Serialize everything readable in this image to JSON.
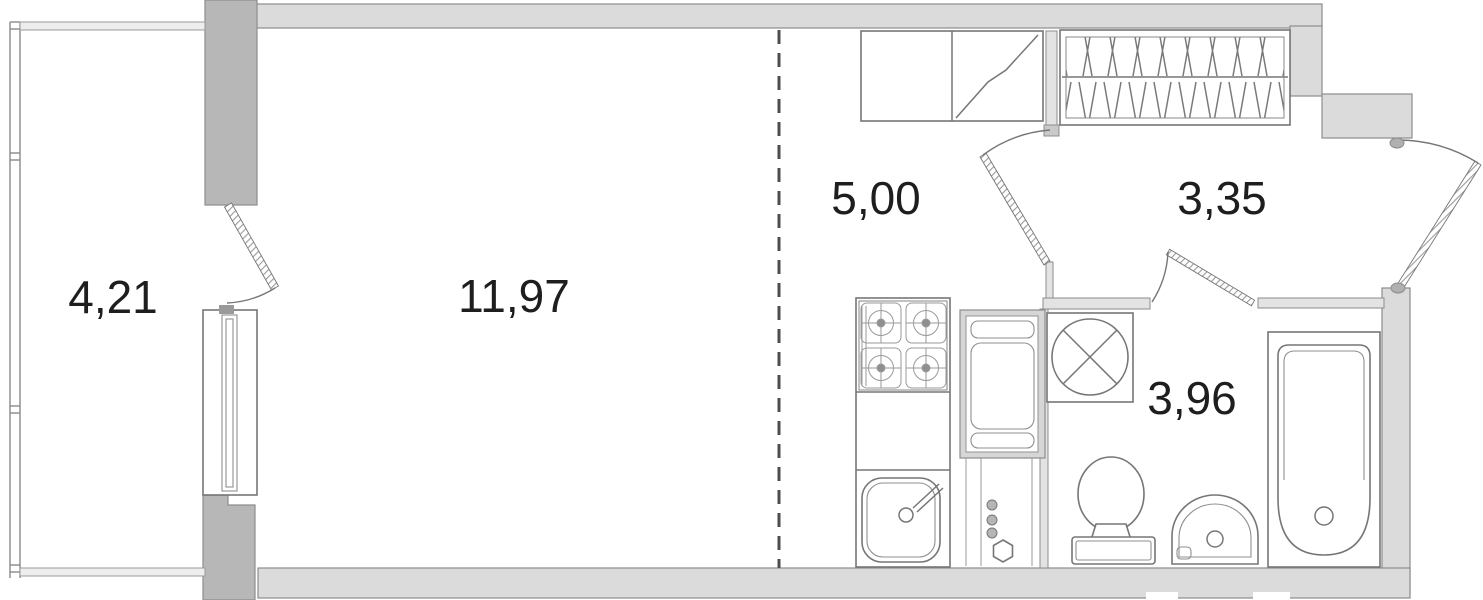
{
  "plan": {
    "type": "studio-apartment-floor-plan",
    "rooms": [
      {
        "name": "balcony",
        "area": "4,21"
      },
      {
        "name": "living-room",
        "area": "11,97"
      },
      {
        "name": "kitchen-area",
        "area": "5,00"
      },
      {
        "name": "hallway",
        "area": "3,35"
      },
      {
        "name": "bathroom",
        "area": "3,96"
      }
    ],
    "fixtures": [
      "balcony-glazing",
      "balcony-door",
      "window",
      "wardrobe",
      "kitchen-cabinets",
      "electric-panel",
      "stove",
      "kitchen-sink",
      "ventilation-shaft",
      "washing-machine",
      "toilet",
      "washbasin",
      "bathtub",
      "interior-door",
      "bathroom-door",
      "entrance-door"
    ],
    "colors": {
      "wall_fill": "#dbdbdb",
      "pillar_fill": "#b7b7b7",
      "partition_fill": "#e3e3e3",
      "wall_stroke": "#8d8d8d",
      "line": "#767676",
      "dash": "#4d4d4d",
      "text": "#1e1e1e",
      "background": "#ffffff"
    }
  }
}
